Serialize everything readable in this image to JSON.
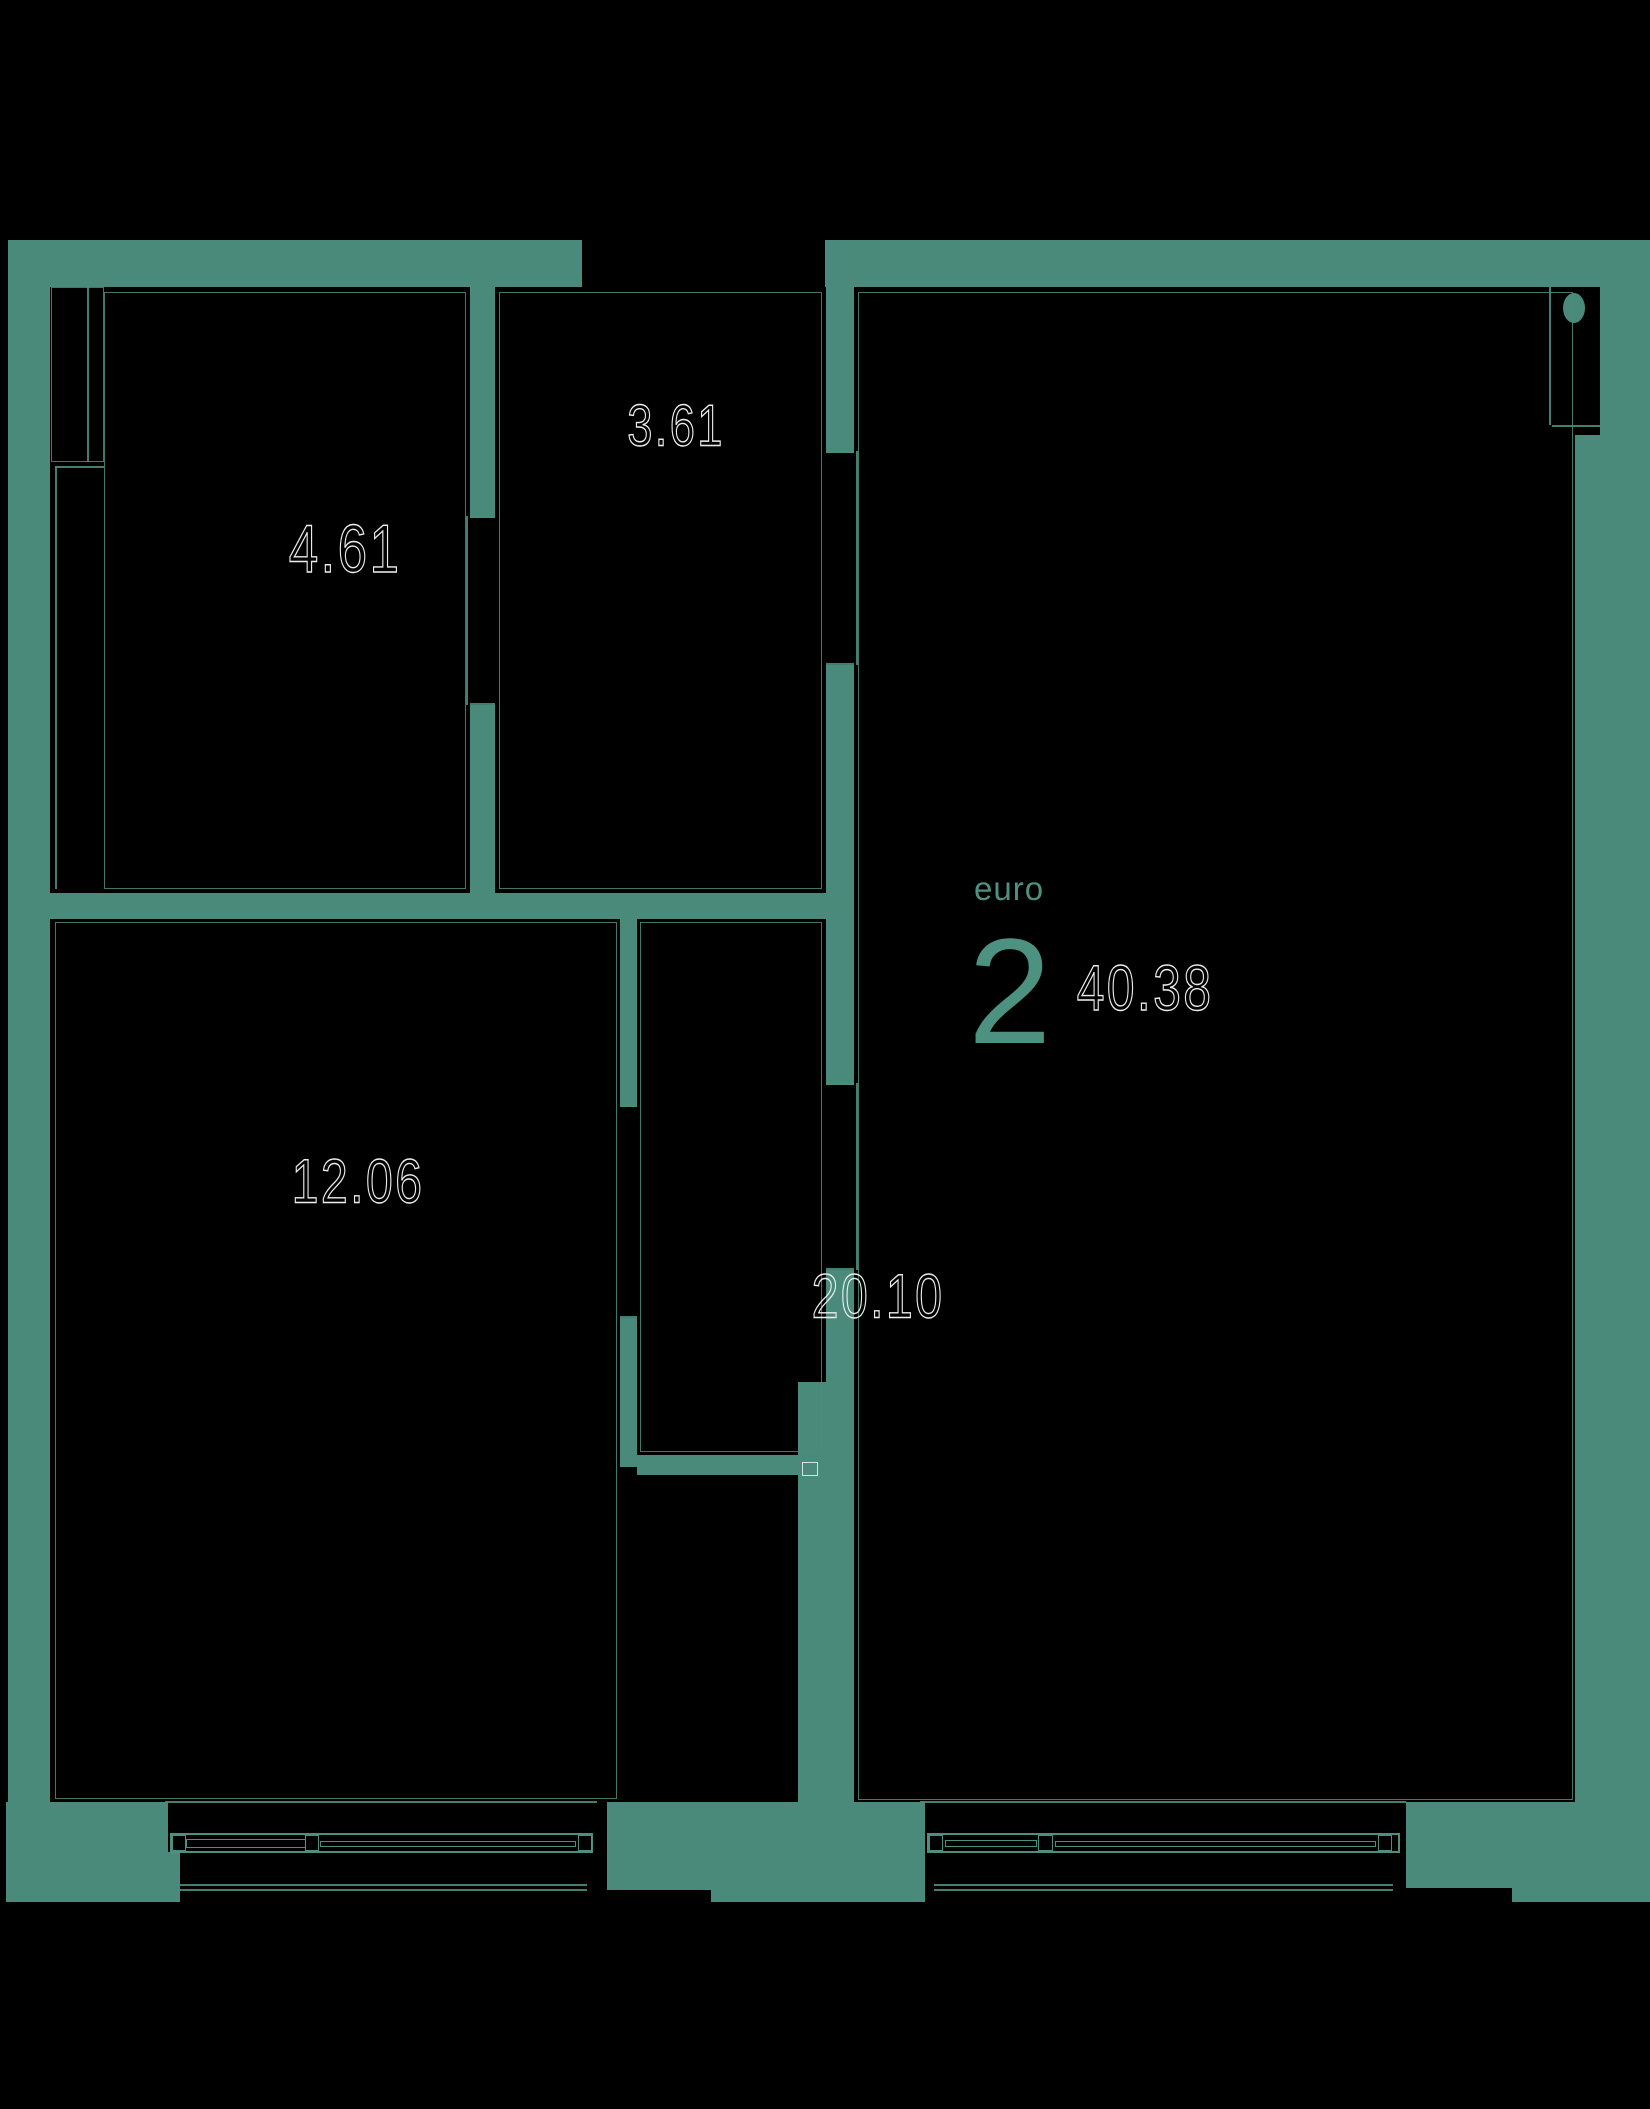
{
  "plan": {
    "unit_type_label": "euro",
    "unit_rooms": "2",
    "total_area": "40.38",
    "rooms": [
      {
        "name": "room-top-left",
        "area": "4.61"
      },
      {
        "name": "hallway-top-middle",
        "area": "3.61"
      },
      {
        "name": "room-bottom-left",
        "area": "12.06"
      },
      {
        "name": "living-kitchen-right",
        "area": "20.10"
      }
    ],
    "colors": {
      "background": "#000000",
      "wall": "#4A8A7A",
      "accent_text": "#4D9180",
      "area_label_stroke": "#ECECEC"
    },
    "features": [
      "entrance-door-notch-top-right",
      "door-hinge-mark",
      "wardrobe-top-left",
      "window-bottom-left",
      "window-bottom-right"
    ]
  }
}
